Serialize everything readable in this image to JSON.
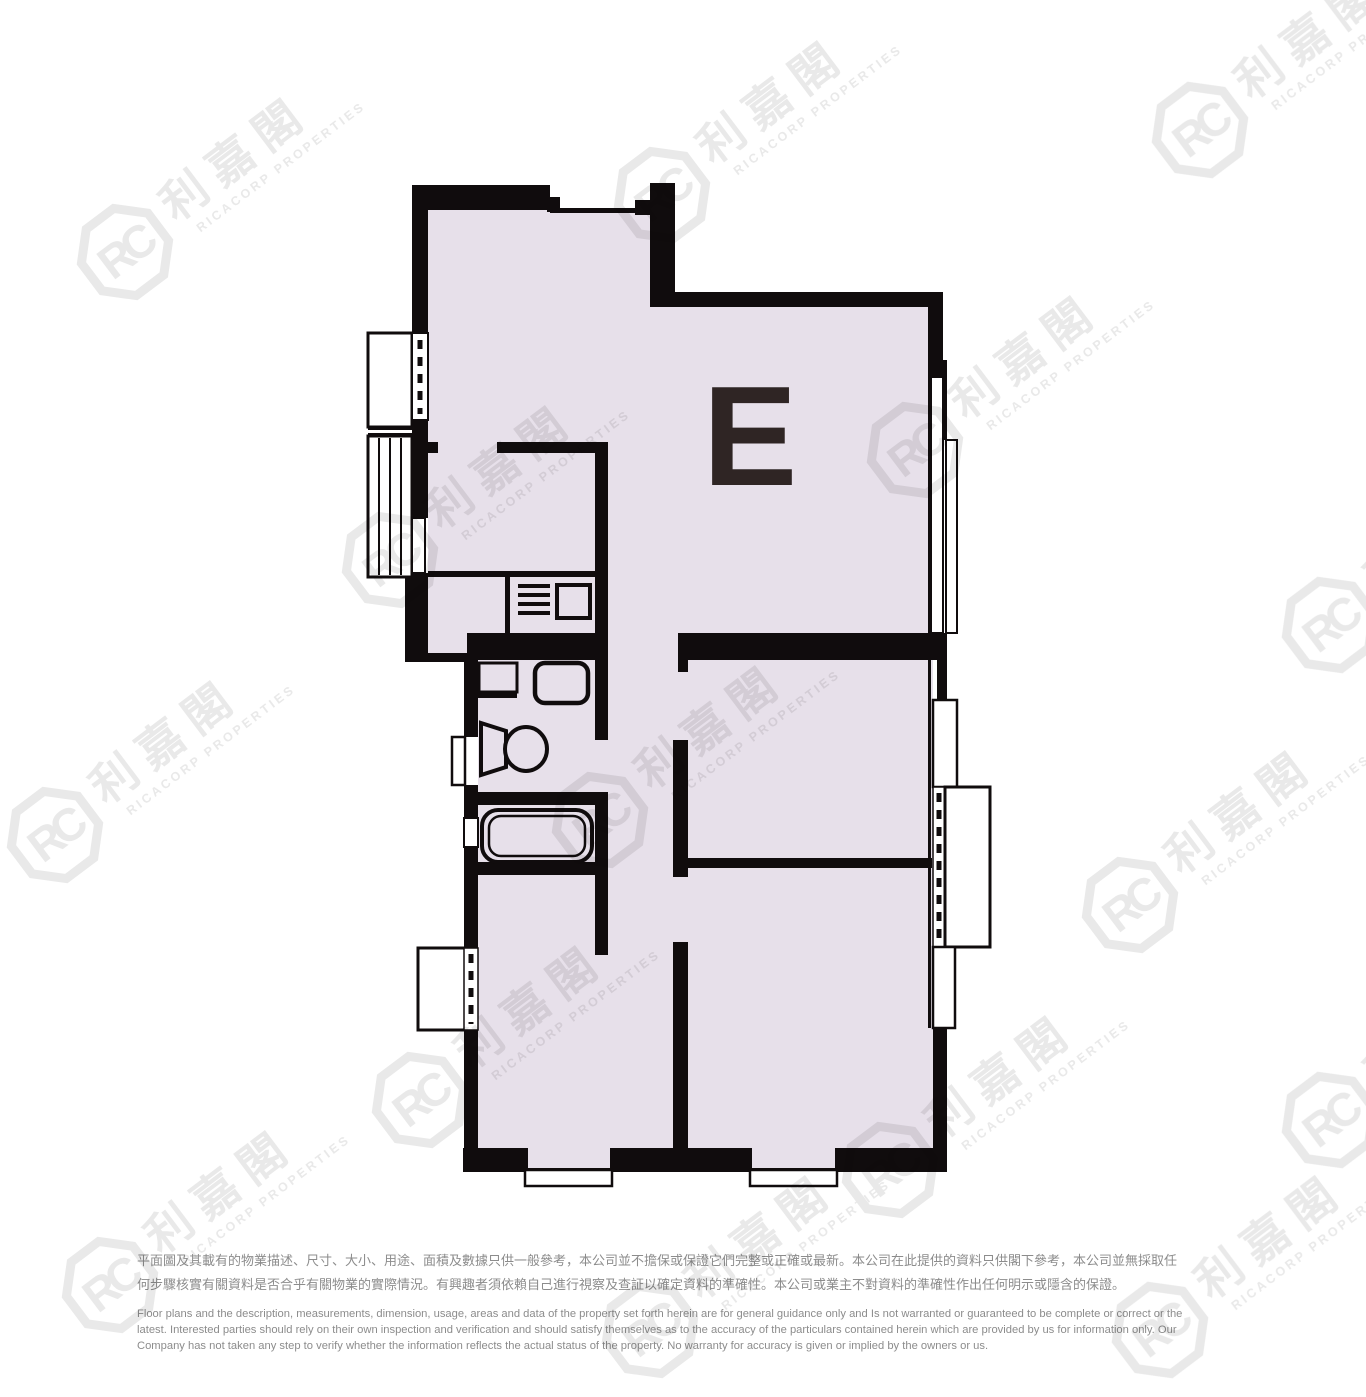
{
  "watermark": {
    "brand_cn": "利嘉閣",
    "brand_en": "RICACORP PROPERTIES",
    "logo_monogram": "RC",
    "color": "#e9e9e9"
  },
  "floorplan": {
    "unit_label": "E",
    "colors": {
      "floor_fill": "#e7e0ea",
      "wall": "#100c0d",
      "unit_label_text": "#2f2524"
    }
  },
  "disclaimer": {
    "text_color": "#8c8c8c",
    "zh_lines": [
      "平面圖及其載有的物業描述、尺寸、大小、用途、面積及數據只供一般參考，本公司並不擔保或保證它們完整或正確或最新。本公司在此提供的資料只供閣下參考，本公司並無採取任",
      "何步驟核實有關資料是否合乎有關物業的實際情況。有興趣者須依賴自己進行視察及查証以確定資料的準確性。本公司或業主不對資料的準確性作出任何明示或隱含的保證。"
    ],
    "en_lines": [
      "Floor plans and the description, measurements, dimension, usage, areas and data of the property set forth herein are for general guidance only and Is not warranted or guaranteed to be complete or correct or the",
      "latest. Interested parties should rely on their own inspection and verification and should satisfy themselves as to the accuracy of the particulars contained herein which are provided by us for information only.  Our",
      "Company has not taken any step to verify whether the information reflects the actual status of the property.  No warranty for accuracy is given or implied by the owners or us."
    ]
  }
}
